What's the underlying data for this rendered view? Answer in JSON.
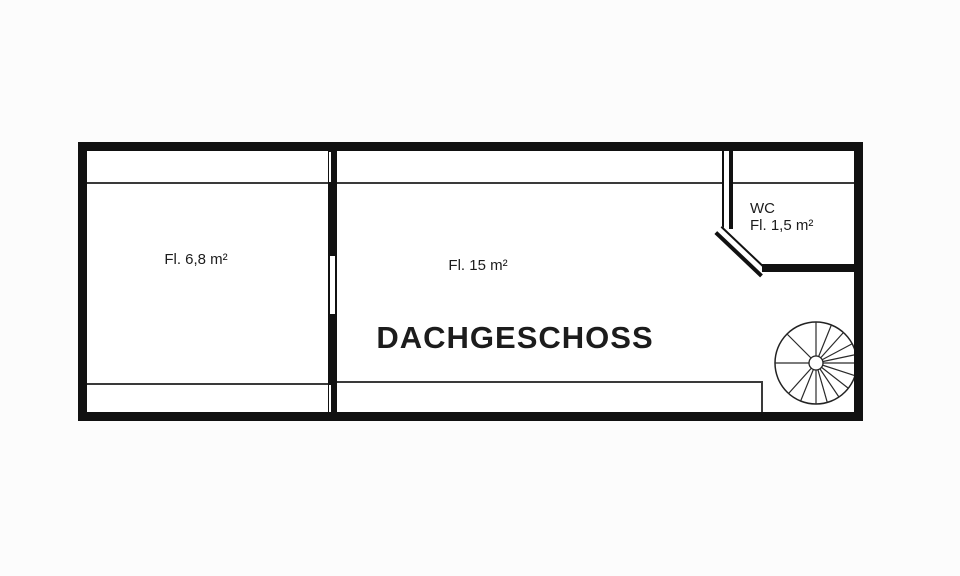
{
  "title": "DACHGESCHOSS",
  "rooms": {
    "left": {
      "area_label": "Fl. 6,8 m²"
    },
    "main": {
      "area_label": "Fl. 15 m²"
    },
    "wc": {
      "label": "WC",
      "area_label": "Fl. 1,5 m²"
    }
  },
  "stair": {
    "type": "spiral-staircase",
    "outer_radius": 41,
    "inner_radius": 7,
    "spoke_angles_deg": [
      90,
      68,
      48,
      28,
      12,
      0,
      -18,
      -38,
      -56,
      -74,
      -90,
      -112,
      -132,
      135,
      180
    ]
  },
  "colors": {
    "wall": "#111111",
    "thin_line": "#3a3a3a",
    "text": "#1c1c1c",
    "background": "#fcfcfc"
  }
}
